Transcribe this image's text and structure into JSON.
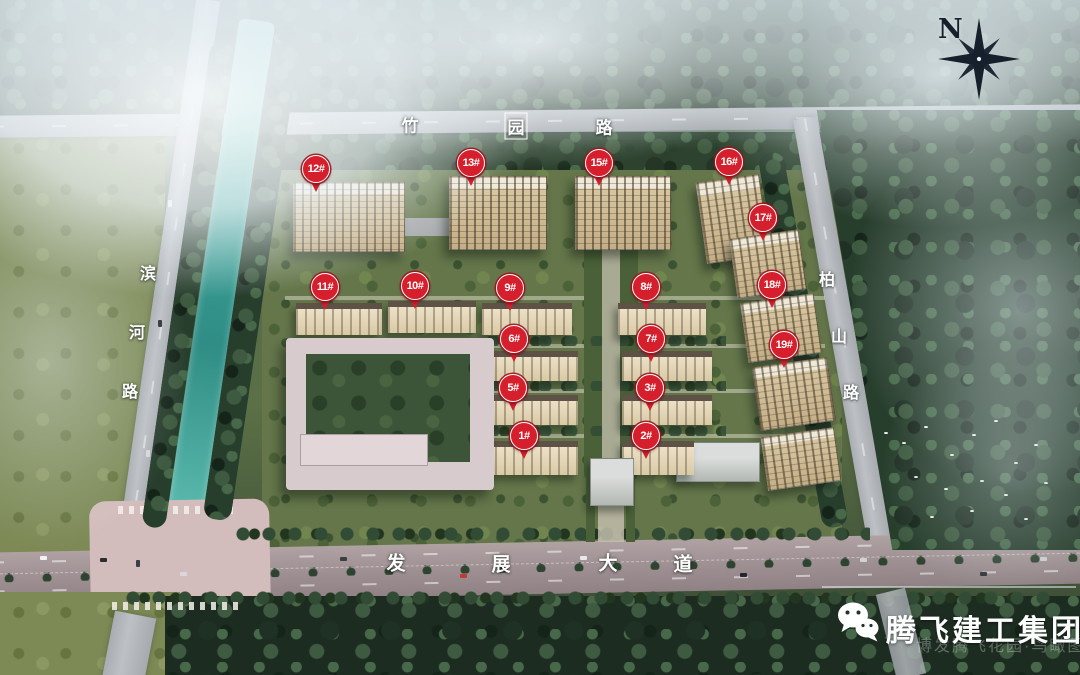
{
  "scene_title": "residential masterplan aerial rendering",
  "compass": {
    "label": "N"
  },
  "road_labels": [
    {
      "id": "zhuyuan-road",
      "name": "竹园路",
      "size": 17,
      "chars": [
        {
          "t": "竹",
          "x": 410,
          "y": 124
        },
        {
          "t": "园",
          "x": 516,
          "y": 126,
          "boxed": true
        },
        {
          "t": "路",
          "x": 604,
          "y": 126
        }
      ]
    },
    {
      "id": "binhe-road",
      "name": "滨河路",
      "size": 16,
      "chars": [
        {
          "t": "滨",
          "x": 148,
          "y": 272
        },
        {
          "t": "河",
          "x": 137,
          "y": 331
        },
        {
          "t": "路",
          "x": 130,
          "y": 390
        }
      ]
    },
    {
      "id": "baishan-road",
      "name": "柏山路",
      "size": 16,
      "chars": [
        {
          "t": "柏",
          "x": 827,
          "y": 278
        },
        {
          "t": "山",
          "x": 839,
          "y": 335
        },
        {
          "t": "路",
          "x": 851,
          "y": 391
        }
      ]
    },
    {
      "id": "fazhan-avenue",
      "name": "发展大道",
      "size": 19,
      "chars": [
        {
          "t": "发",
          "x": 396,
          "y": 562
        },
        {
          "t": "展",
          "x": 501,
          "y": 563
        },
        {
          "t": "大",
          "x": 608,
          "y": 562
        },
        {
          "t": "道",
          "x": 683,
          "y": 563
        }
      ]
    }
  ],
  "markers": [
    {
      "label": "12#",
      "x": 316,
      "y": 170
    },
    {
      "label": "13#",
      "x": 471,
      "y": 164
    },
    {
      "label": "15#",
      "x": 599,
      "y": 164
    },
    {
      "label": "16#",
      "x": 729,
      "y": 163
    },
    {
      "label": "17#",
      "x": 763,
      "y": 219
    },
    {
      "label": "11#",
      "x": 325,
      "y": 288
    },
    {
      "label": "10#",
      "x": 415,
      "y": 287
    },
    {
      "label": "9#",
      "x": 510,
      "y": 289
    },
    {
      "label": "8#",
      "x": 646,
      "y": 288
    },
    {
      "label": "18#",
      "x": 772,
      "y": 286
    },
    {
      "label": "6#",
      "x": 514,
      "y": 340
    },
    {
      "label": "7#",
      "x": 651,
      "y": 340
    },
    {
      "label": "19#",
      "x": 784,
      "y": 346
    },
    {
      "label": "5#",
      "x": 513,
      "y": 389
    },
    {
      "label": "3#",
      "x": 650,
      "y": 389
    },
    {
      "label": "1#",
      "x": 524,
      "y": 437
    },
    {
      "label": "2#",
      "x": 646,
      "y": 437
    }
  ],
  "branding": {
    "company": "腾飞建工集团",
    "watermark": "博发腾飞花园·鸟瞰图",
    "icon": "wechat-icon"
  },
  "colors": {
    "marker_red": "#d61f2c",
    "river_teal": "#3fa79c",
    "compass_dark": "#15202c"
  }
}
